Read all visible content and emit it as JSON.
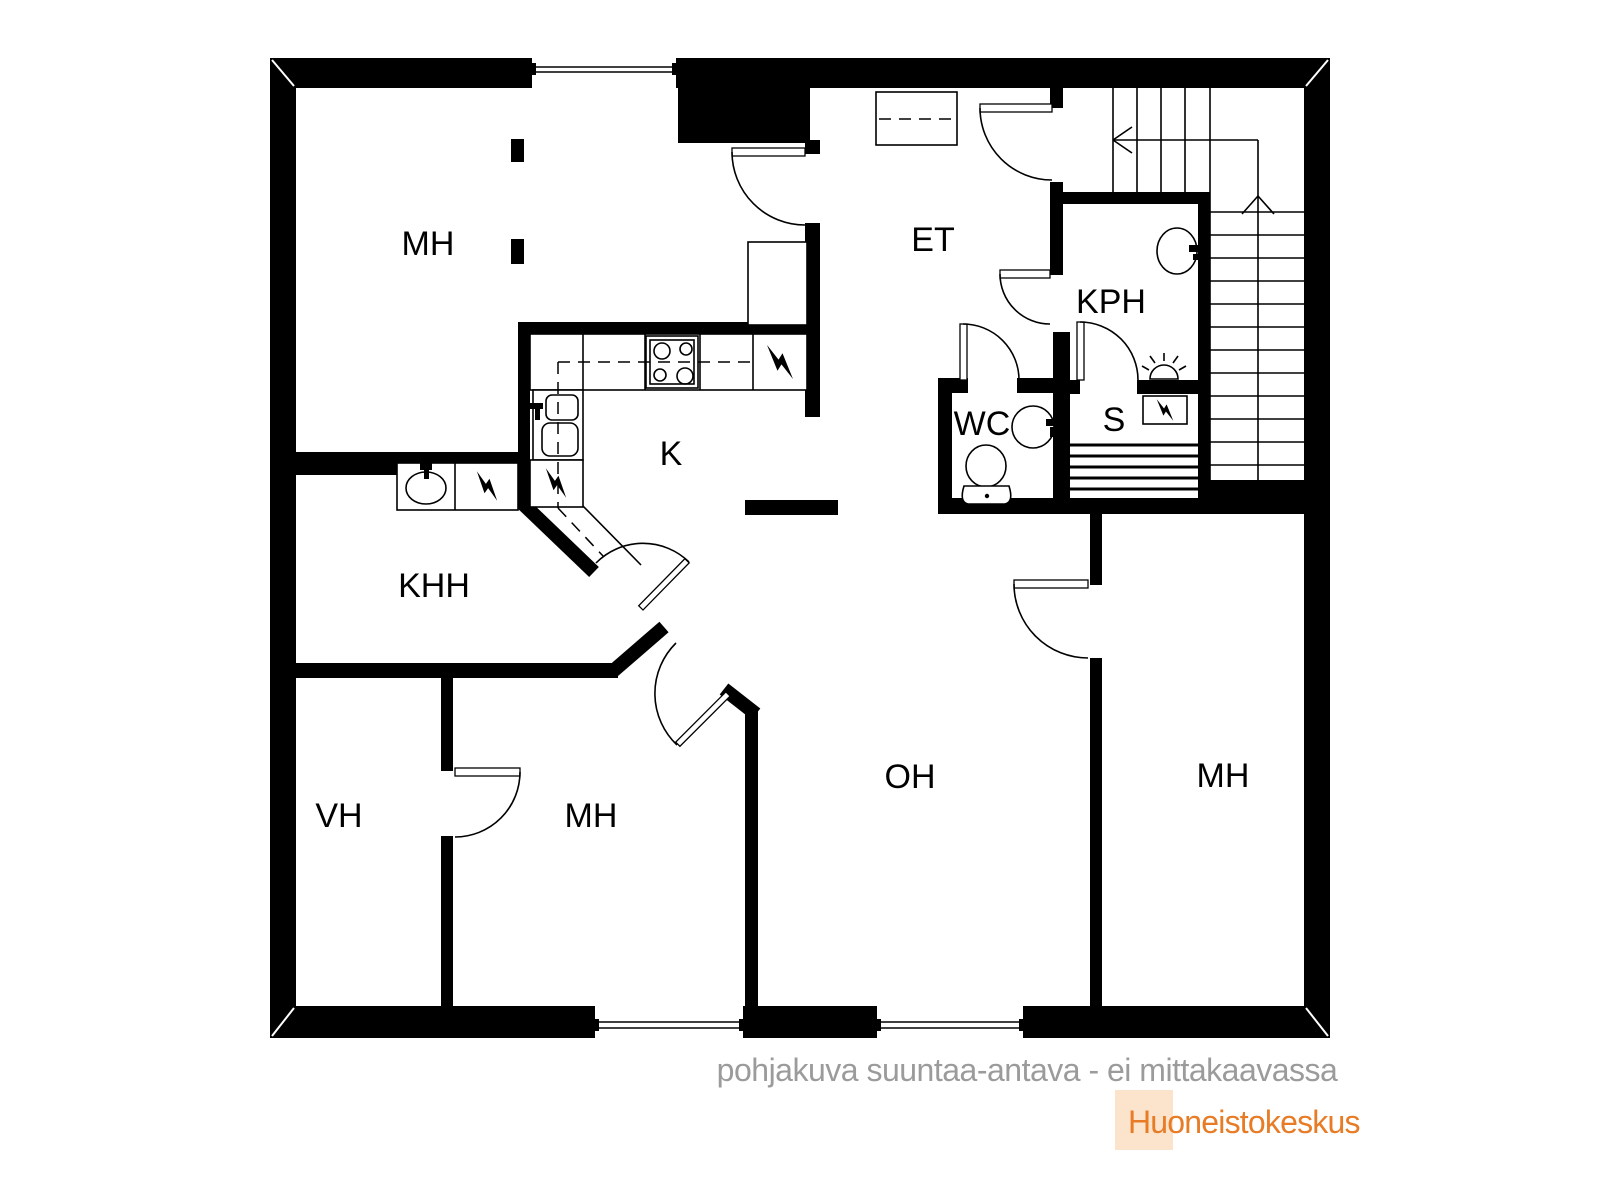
{
  "plan": {
    "rooms": {
      "bedroom_top_left": {
        "label": "MH"
      },
      "hallway": {
        "label": "ET"
      },
      "bathroom": {
        "label": "KPH"
      },
      "toilet": {
        "label": "WC"
      },
      "sauna": {
        "label": "S"
      },
      "kitchen": {
        "label": "K"
      },
      "utility": {
        "label": "KHH"
      },
      "closet": {
        "label": "VH"
      },
      "bedroom_bottom": {
        "label": "MH"
      },
      "living_room": {
        "label": "OH"
      },
      "bedroom_right": {
        "label": "MH"
      }
    },
    "caption": "pohjakuva suuntaa-antava - ei mittakaavassa",
    "brand": {
      "name": "Huoneistokeskus"
    },
    "colors": {
      "wall": "#000000",
      "caption_gray": "#9b9b9b",
      "brand_orange": "#e87c26",
      "brand_bg": "#fbe4cb"
    }
  }
}
